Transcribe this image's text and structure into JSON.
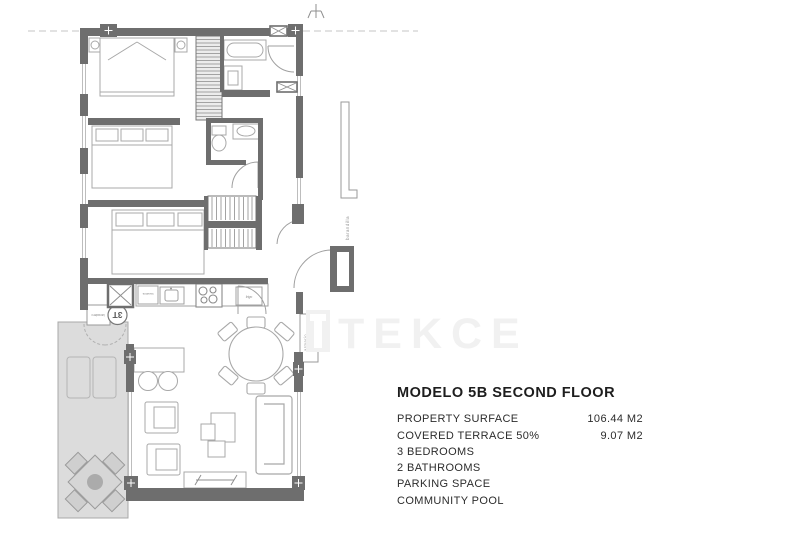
{
  "info": {
    "title": "MODELO 5B SECOND FLOOR",
    "specs": [
      {
        "label": "PROPERTY SURFACE",
        "value": "106.44 M2"
      },
      {
        "label": "COVERED TERRACE 50%",
        "value": "9.07 M2"
      },
      {
        "label": "3 BEDROOMS",
        "value": ""
      },
      {
        "label": "2 BATHROOMS",
        "value": ""
      },
      {
        "label": "PARKING SPACE",
        "value": ""
      },
      {
        "label": "COMMUNITY POOL",
        "value": ""
      }
    ]
  },
  "plan": {
    "watermark": "TEKCE",
    "labels": {
      "railing": "barandilla",
      "wardrobe": "armario",
      "unit": "3T",
      "utility": "lavadero",
      "washer": "lavadora",
      "fridge": "frigo"
    },
    "colors": {
      "wall": "#6e6e6e",
      "terrace_fill": "#dcdcdc",
      "furniture_line": "#a8a8a8",
      "watermark": "#f1f1f1",
      "text": "#1d1d1d"
    }
  }
}
